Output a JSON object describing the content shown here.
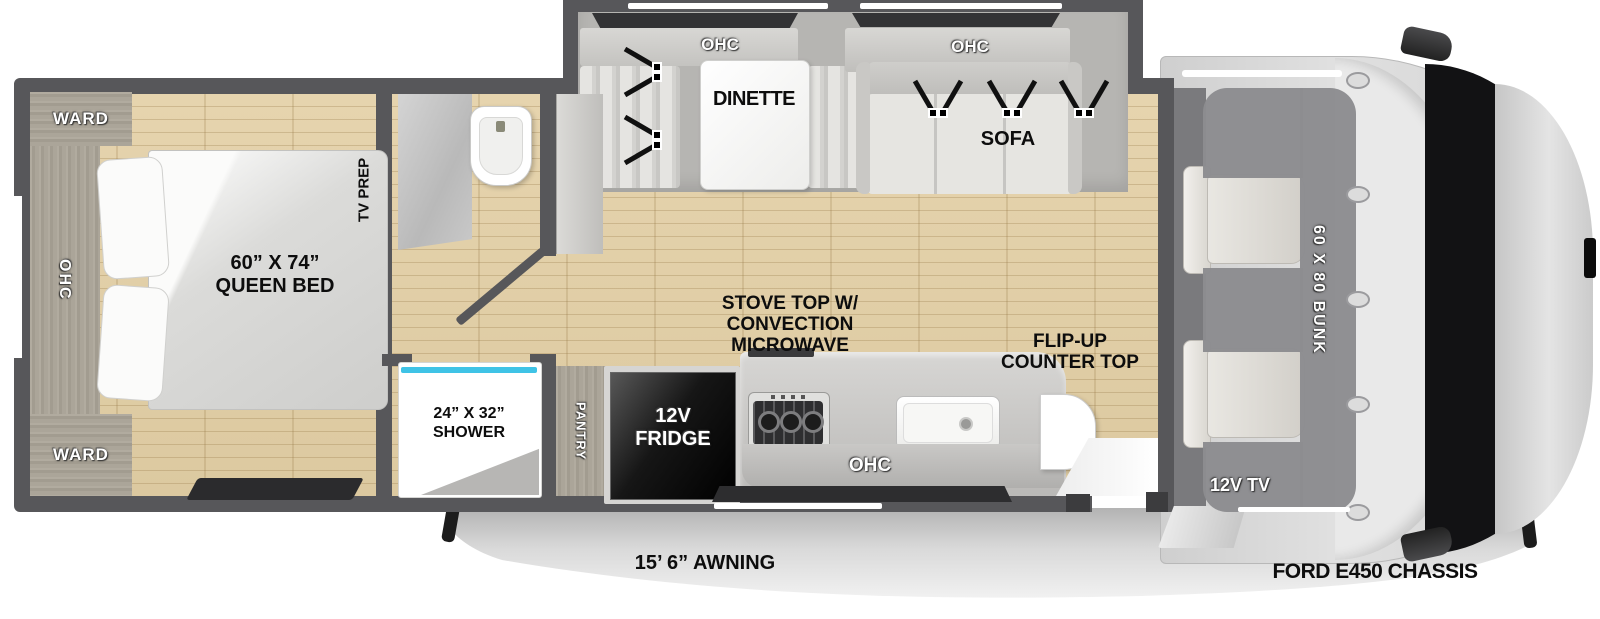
{
  "colors": {
    "wall": "#57575a",
    "floor": "#e0cda6",
    "cabinet_wood": "#a49e92",
    "slide_gray": "#b6b5b2",
    "window_dark": "#333335",
    "shower_glass": "#3fc3e6",
    "fridge_black": "#0a0a0a",
    "bunk_gray": "#8c8c8f",
    "cab_gray": "#d7d7d7",
    "hood_black": "#121214",
    "awning_gray": "#c9c9c9",
    "label_black": "#0d0d0d"
  },
  "bedroom": {
    "ward_top": "WARD",
    "ward_bottom": "WARD",
    "ohc": "OHC",
    "bed_line1": "60” X 74”",
    "bed_line2": "QUEEN BED",
    "tv_prep": "TV PREP"
  },
  "bath": {
    "shower_line1": "24” X 32”",
    "shower_line2": "SHOWER"
  },
  "kitchen": {
    "pantry": "PANTRY",
    "fridge_line1": "12V",
    "fridge_line2": "FRIDGE",
    "stove_line1": "STOVE TOP W/",
    "stove_line2": "CONVECTION",
    "stove_line3": "MICROWAVE",
    "ohc": "OHC",
    "flip_line1": "FLIP-UP",
    "flip_line2": "COUNTER TOP"
  },
  "living": {
    "dinette_ohc": "OHC",
    "dinette": "DINETTE",
    "sofa_ohc": "OHC",
    "sofa": "SOFA"
  },
  "front": {
    "bunk": "60 X 80 BUNK",
    "tv": "12V TV",
    "chassis": "FORD E450 CHASSIS"
  },
  "exterior": {
    "awning": "15’ 6” AWNING"
  }
}
